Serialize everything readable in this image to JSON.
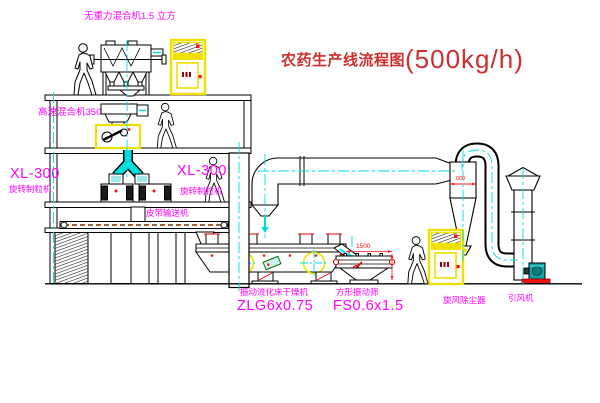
{
  "drawing": {
    "title_zh": "农药生产线流程图",
    "title_capacity": "(500kg/h)"
  },
  "equipment_labels": {
    "gravity_free_mixer": "无重力混合机1.5 立方",
    "high_speed_mixer": "高速混合机350",
    "granulator_left_model": "XL-300",
    "granulator_left_name": "旋转制粒机",
    "granulator_center_model": "XL-300",
    "granulator_center_name": "旋转制粒机",
    "belt_conveyor": "皮带输送机",
    "fluid_bed_dryer_name": "振动流化床干燥机",
    "fluid_bed_dryer_model": "ZLG6x0.75",
    "square_sieve_name": "方形振动筛",
    "square_sieve_model": "FS0.6x1.5",
    "cyclone_dust_collector": "旋风除尘器",
    "induced_draft_fan": "引风机"
  },
  "dimensions": {
    "sieve_length_mm": "1500",
    "cyclone_diameter_mm": "600"
  },
  "colors": {
    "label_magenta": "#ff00ff",
    "title_red": "#cc2f2f",
    "dimension_red": "#ff1111",
    "line_black": "#000000",
    "centerline_cyan": "#00dddd",
    "chute_cyan": "#00dfdf",
    "highlight_yellow": "#f0e000",
    "fan_teal": "#0fa3a3",
    "base_red": "#ee1111",
    "background": "#ffffff"
  }
}
